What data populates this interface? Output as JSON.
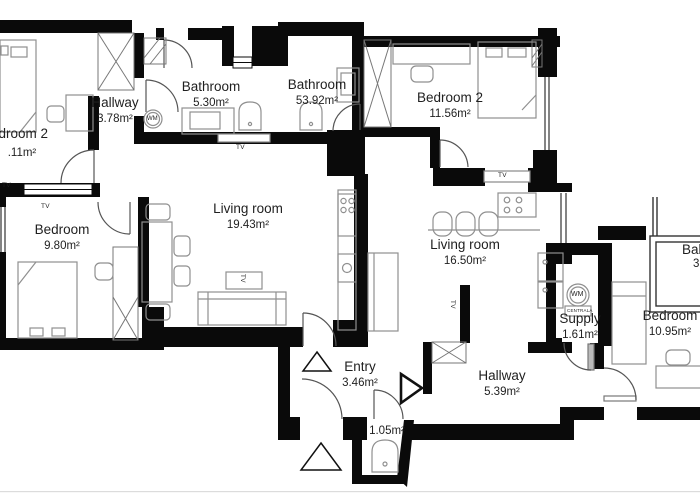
{
  "meta": {
    "wall_color": "#0a0a0a",
    "furniture_color": "#8f8f8f",
    "door_color": "#555555",
    "background": "#ffffff"
  },
  "rooms": [
    {
      "id": "bedroom2-left",
      "name": "Bedroom 2",
      "area": ".11m²"
    },
    {
      "id": "hallway-a",
      "name": "Hallway",
      "area": "3.78m²"
    },
    {
      "id": "bathroom-a",
      "name": "Bathroom",
      "area": "5.30m²"
    },
    {
      "id": "bathroom-b",
      "name": "Bathroom",
      "area": "53.92m²"
    },
    {
      "id": "bedroom2-right",
      "name": "Bedroom 2",
      "area": "11.56m²"
    },
    {
      "id": "bedroom-a",
      "name": "Bedroom",
      "area": "9.80m²"
    },
    {
      "id": "living-a",
      "name": "Living room",
      "area": "19.43m²"
    },
    {
      "id": "living-b",
      "name": "Living room",
      "area": "16.50m²"
    },
    {
      "id": "supply",
      "name": "Supply",
      "area": "1.61m²"
    },
    {
      "id": "hallway-b",
      "name": "Hallway",
      "area": "5.39m²"
    },
    {
      "id": "entry",
      "name": "Entry",
      "area": "3.46m²"
    },
    {
      "id": "wc",
      "name": "",
      "area": "1.05m²"
    },
    {
      "id": "bedroom-c",
      "name": "Bedroom",
      "area": "10.95m²"
    },
    {
      "id": "balcony",
      "name": "Balcony",
      "area": "3."
    }
  ],
  "labels": {
    "tv": "TV",
    "wm": "WM",
    "centrala": "CENTRALA"
  }
}
